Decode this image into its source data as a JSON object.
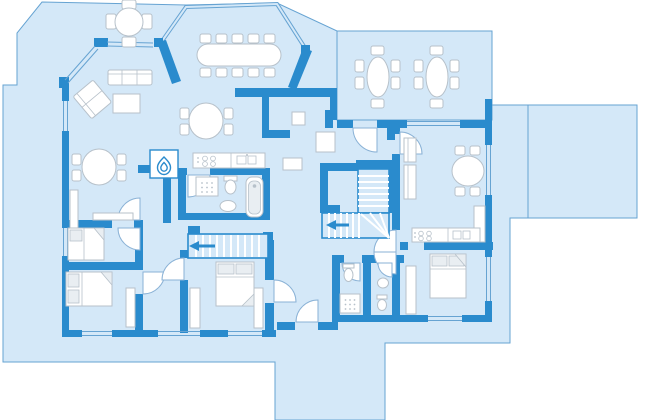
{
  "palette": {
    "background": "#ffffff",
    "floor": "#d4e8f8",
    "plot_outline": "#66a3d2",
    "wall": "#2a8bcd",
    "furniture_fill": "#ffffff",
    "furniture_stroke": "#b7c1ca",
    "furniture_shade": "#e9eef2",
    "door_arc": "#8ab2d6"
  },
  "plan": {
    "kind": "residential-floor-plan",
    "areas": [
      {
        "name": "west-patio",
        "furniture": [
          "round-table",
          "chair-x4"
        ]
      },
      {
        "name": "conservatory",
        "furniture": [
          "banquet-table",
          "chair-x10"
        ],
        "enclosure": "glass-double-line"
      },
      {
        "name": "north-terrace",
        "furniture": [
          "oval-table-x2",
          "chair-x12"
        ],
        "enclosure": "thin-border"
      },
      {
        "name": "east-terrace",
        "furniture": [],
        "enclosure": "thin-border"
      },
      {
        "name": "sitting-room",
        "furniture": [
          "sofa",
          "angled-loveseat",
          "coffee-table"
        ],
        "feature": "bay-window"
      },
      {
        "name": "dining-room",
        "furniture": [
          "oval-table",
          "chair-x4",
          "sideboard",
          "cabinet"
        ]
      },
      {
        "name": "breakfast-nook",
        "furniture": [
          "oval-table",
          "chair-x4"
        ]
      },
      {
        "name": "kitchen",
        "furniture": [
          "hob-4-burners",
          "double-sink-counter"
        ]
      },
      {
        "name": "bathroom",
        "furniture": [
          "shower",
          "toilet",
          "washbasin",
          "bathtub"
        ]
      },
      {
        "name": "hearth",
        "furniture": [
          "fireplace"
        ]
      },
      {
        "name": "bedroom-west-small",
        "furniture": [
          "single-bed"
        ]
      },
      {
        "name": "bedroom-west-large",
        "furniture": [
          "double-bed",
          "wardrobe"
        ]
      },
      {
        "name": "bedroom-center",
        "furniture": [
          "double-bed",
          "wardrobe-x2"
        ]
      },
      {
        "name": "entrance-hall",
        "furniture": [
          "bench",
          "shaft-box",
          "wall-niche"
        ]
      },
      {
        "name": "shower-room",
        "furniture": [
          "shower",
          "toilet"
        ]
      },
      {
        "name": "wc",
        "furniture": [
          "washbasin",
          "toilet"
        ]
      },
      {
        "name": "family-room-east",
        "furniture": [
          "oval-table",
          "chair-x4",
          "sofa-x2",
          "tall-cabinet",
          "hob-4-burners",
          "double-sink-counter"
        ]
      },
      {
        "name": "bedroom-east",
        "furniture": [
          "double-bed",
          "wardrobe"
        ]
      }
    ],
    "stairs": [
      {
        "name": "stairs-west",
        "direction_icon": "stair-arrow-left",
        "treads": 11,
        "shape": "straight"
      },
      {
        "name": "stairs-central",
        "direction_icon": "stair-arrow-left",
        "treads": 14,
        "shape": "l-winder"
      }
    ],
    "icons": [
      "flame-icon",
      "shower-head-dots",
      "stair-arrow-left",
      "door-swing-arc"
    ],
    "door_count": 12,
    "window_count": 12
  }
}
